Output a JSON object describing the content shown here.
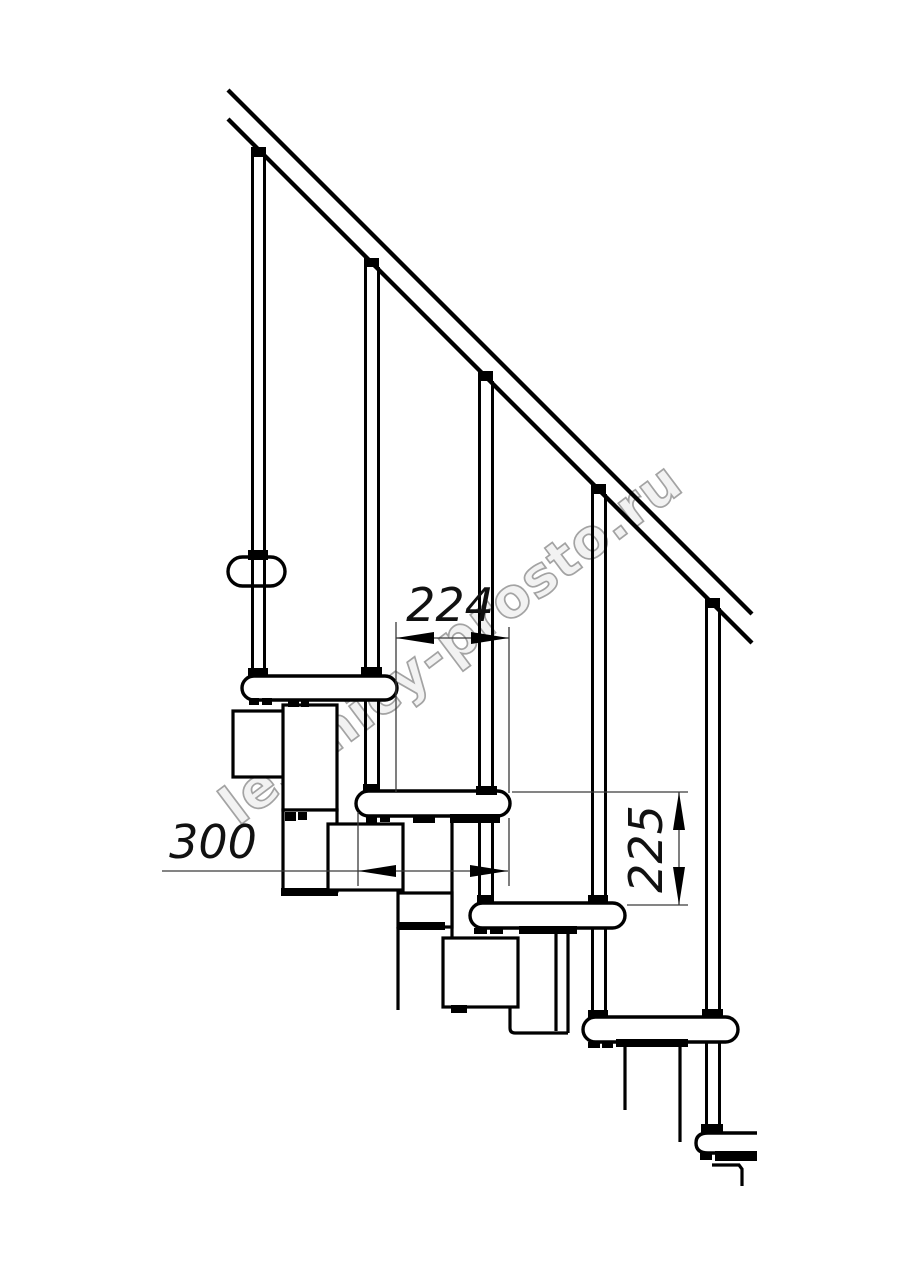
{
  "page": {
    "background": "#ffffff",
    "width": 914,
    "height": 1280
  },
  "drawing": {
    "type": "technical-diagram",
    "subject": "modular staircase side elevation with railing",
    "line_color": "#000000",
    "dim_line_color": "#3a3a3a",
    "watermark": {
      "text": "lestnicy-prosto.ru",
      "stroke_color": "#a3a3a3",
      "fill_color": "#f2f2f2",
      "angle_deg": -37
    },
    "dimensions": {
      "step_run": {
        "label": "224",
        "orientation": "horizontal"
      },
      "tread_depth": {
        "label": "300",
        "orientation": "horizontal"
      },
      "riser_height": {
        "label": "225",
        "orientation": "vertical"
      }
    }
  }
}
